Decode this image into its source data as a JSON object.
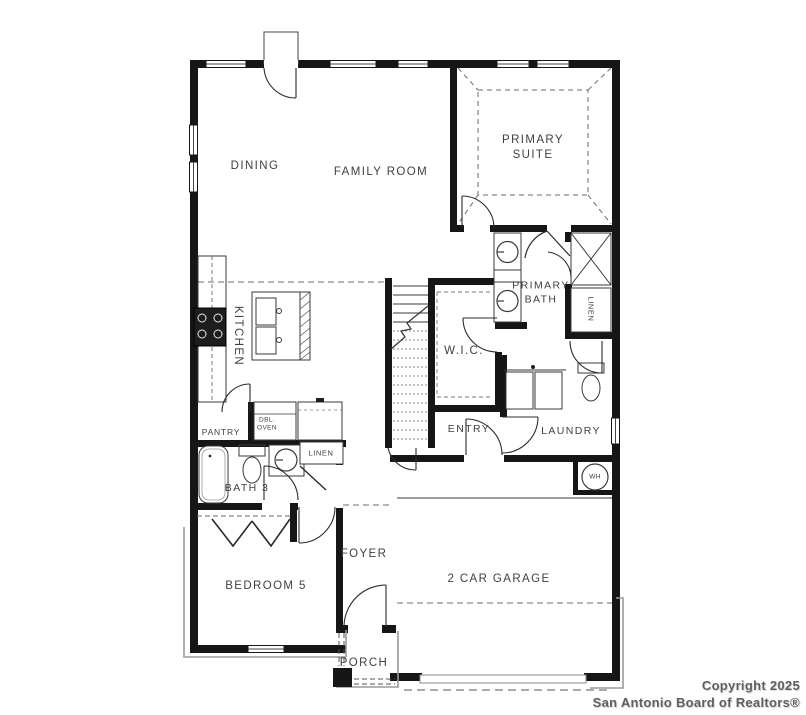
{
  "labels": {
    "dining": "DINING",
    "family_room": "FAMILY ROOM",
    "primary_suite": "PRIMARY SUITE",
    "kitchen": "KITCHEN",
    "primary_bath": "PRIMARY BATH",
    "wic": "W.I.C.",
    "linen_upper": "LINEN",
    "linen_lower": "LINEN",
    "pantry": "PANTRY",
    "dbl_oven": "DBL. OVEN",
    "bath3": "BATH 3",
    "entry": "ENTRY",
    "laundry": "LAUNDRY",
    "bedroom5": "BEDROOM 5",
    "foyer": "FOYER",
    "garage": "2 CAR GARAGE",
    "porch": "PORCH",
    "water_heater": "WH"
  },
  "copyright": {
    "line1": "Copyright 2025",
    "line2": "San Antonio Board of Realtors®"
  },
  "colors": {
    "wall": "#161616",
    "label_text": "#3e3f45",
    "copyright_text": "#5f5f60",
    "background": "#ffffff"
  }
}
